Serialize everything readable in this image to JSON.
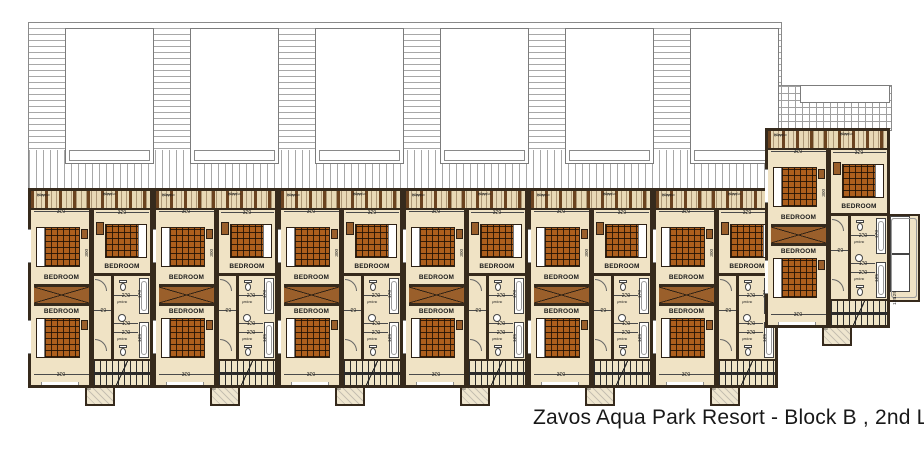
{
  "caption": "Zavos Aqua Park Resort - Block B , 2nd Level",
  "unit": {
    "bedroom": "BEDROOM",
    "bath": "μπάνιο",
    "pergola_line1": "ξύλινη",
    "pergola_line2": "πέργολα",
    "dims": {
      "d300": "300",
      "d320": "320",
      "d90": "90",
      "d220": "220",
      "d120": "120",
      "d170": "170",
      "d125": "125"
    }
  },
  "layout": {
    "standard_units_x": [
      28,
      153,
      278,
      403,
      528,
      653
    ],
    "standard_units_y": 188,
    "end_unit_x": 765,
    "end_unit_y": 128,
    "roof_openings_x": [
      65,
      190,
      315,
      440,
      565,
      690
    ]
  },
  "colors": {
    "wall": "#362a1c",
    "floor": "#f0e3c5",
    "bed_blanket": "#ad5f1d",
    "wood": "#9a5f2b",
    "hatch": "#a8a8a8"
  }
}
